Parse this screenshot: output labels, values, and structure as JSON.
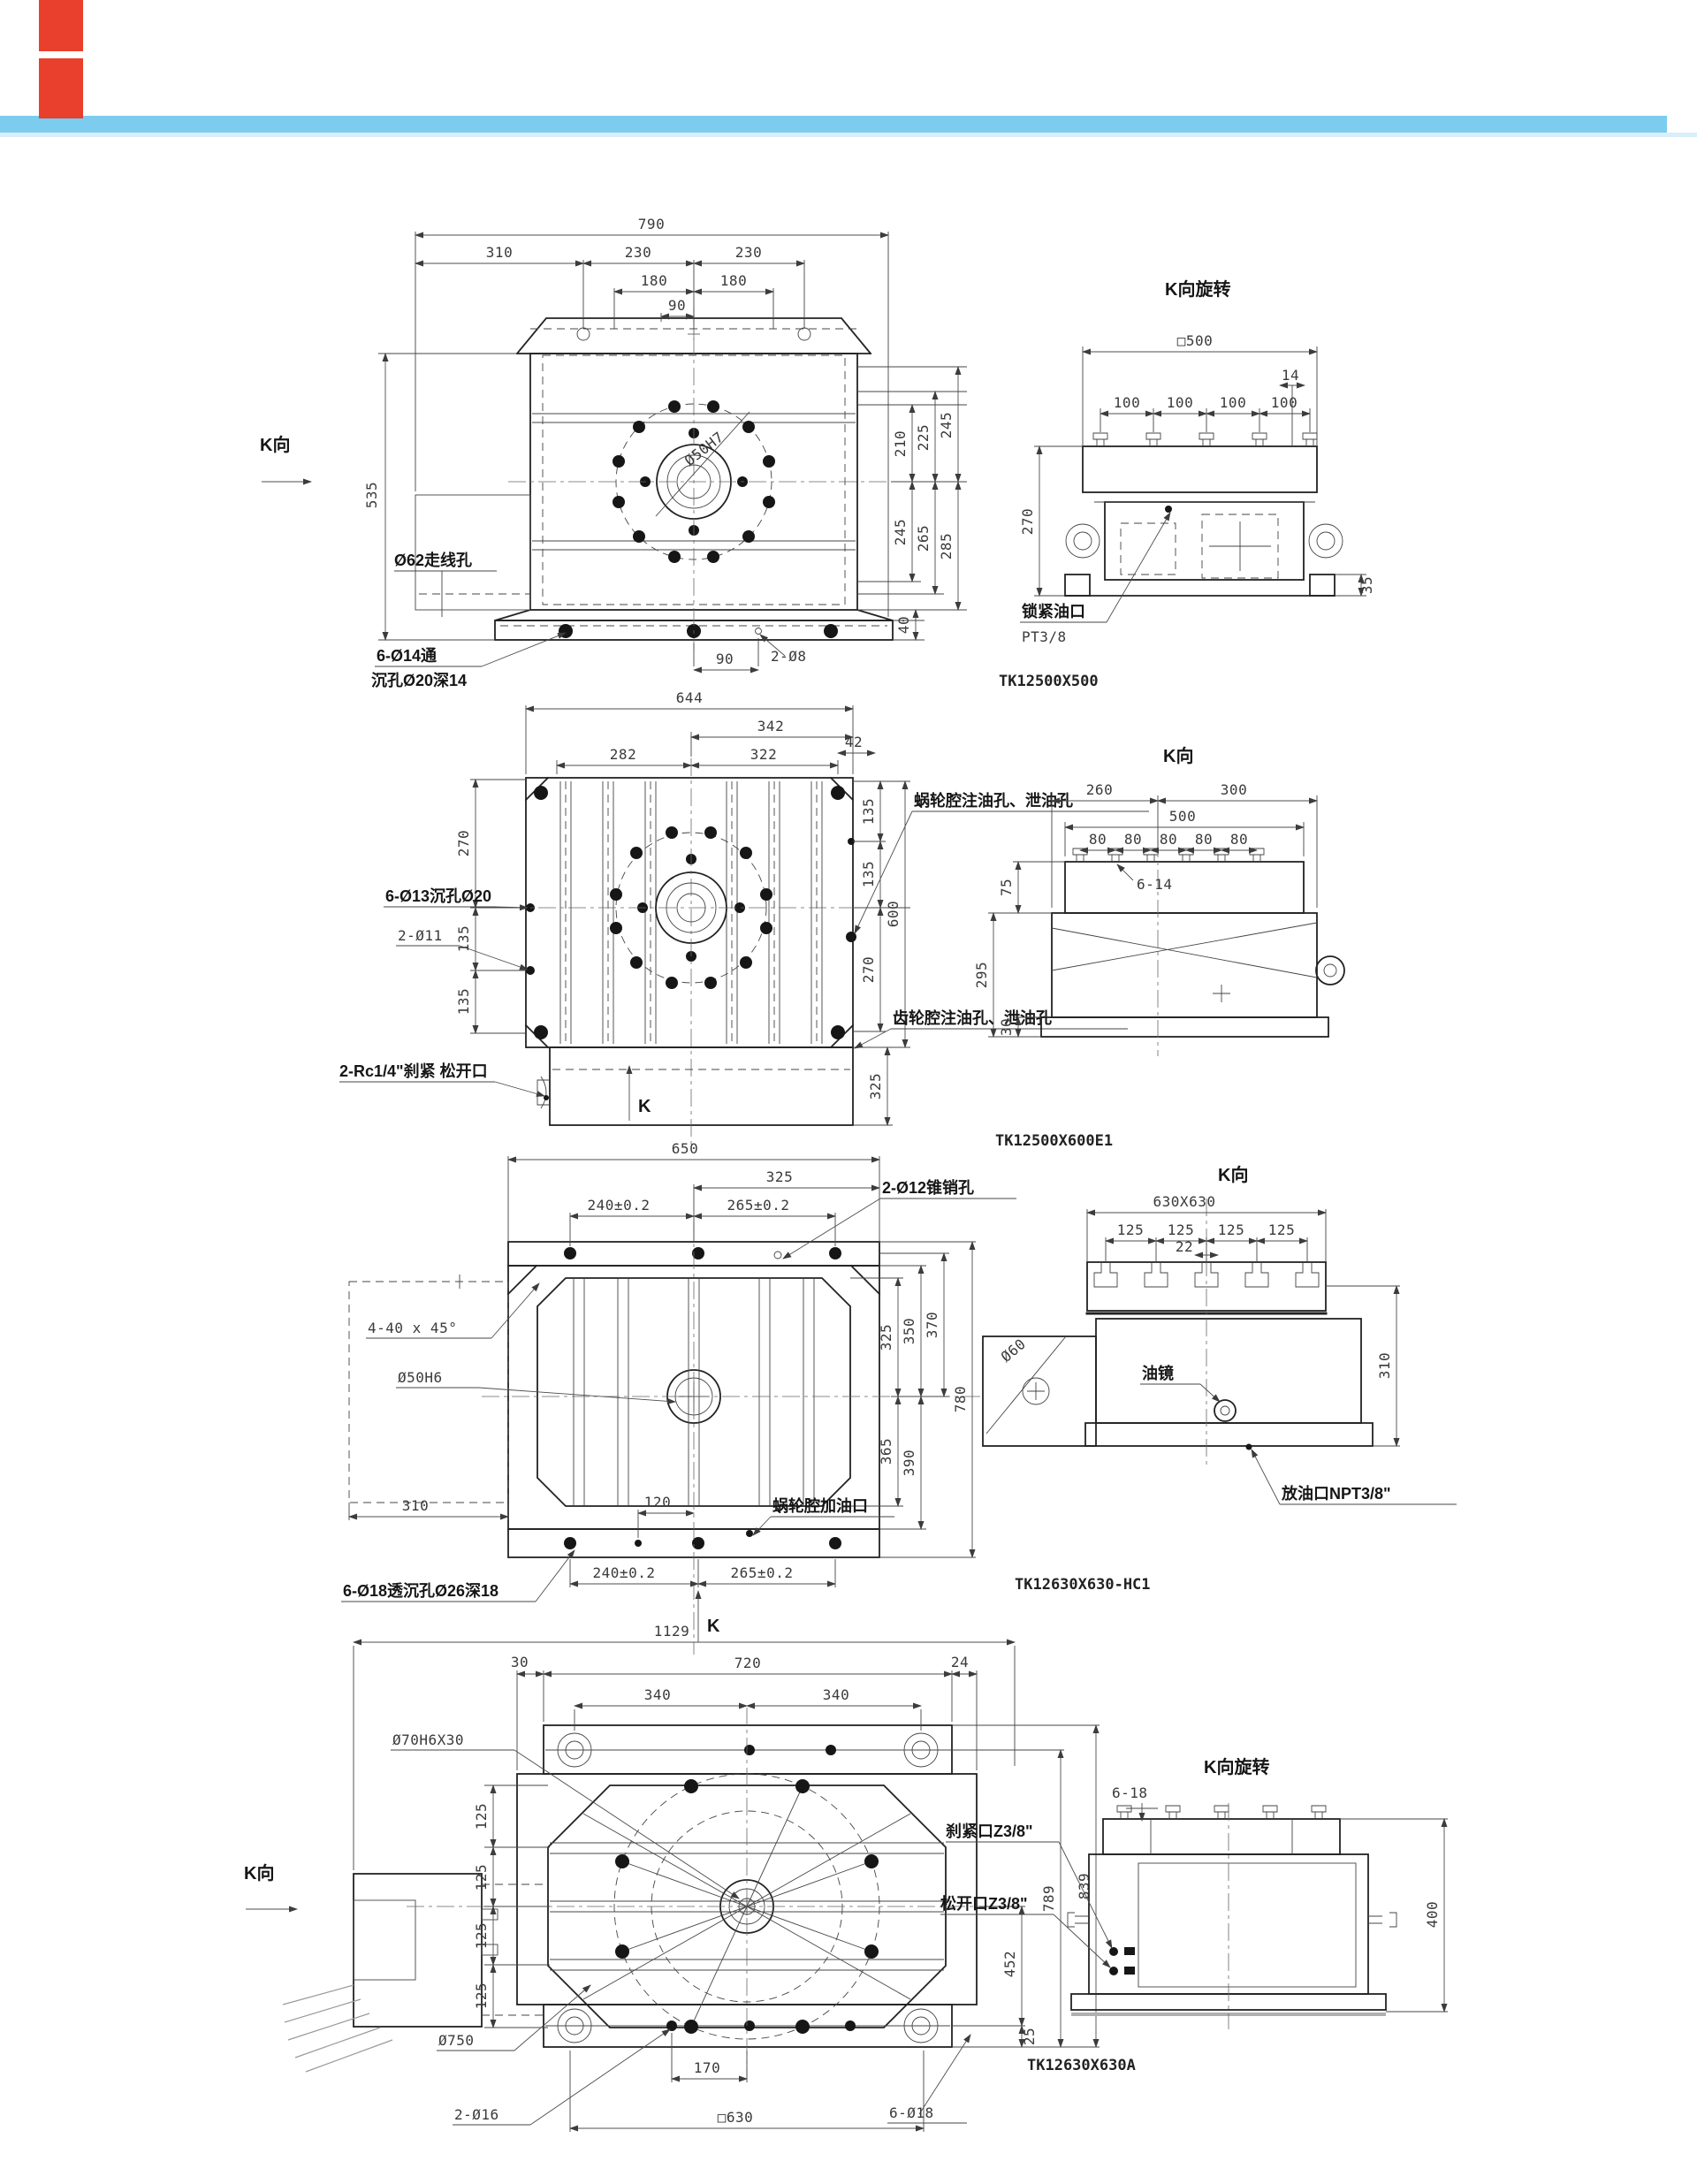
{
  "page": {
    "accent_band_color": "#7cccf0",
    "accent_band_light_color": "#d8eefa",
    "marker_color": "#e8402c"
  },
  "g1": {
    "model": "TK12500X500",
    "f": {
      "d790": "790",
      "d310": "310",
      "d230a": "230",
      "d230b": "230",
      "d180a": "180",
      "d180b": "180",
      "d90t": "90",
      "d535": "535",
      "d210": "210",
      "d225": "225",
      "d245a": "245",
      "d245b": "245",
      "d265": "265",
      "d285": "285",
      "d40": "40",
      "d90b": "90",
      "k": "K向",
      "wire": "Ø62走线孔",
      "cb1": "6-Ø14通",
      "cb2": "沉孔Ø20深14",
      "pin": "2-Ø8",
      "bore": "Ø50H7"
    },
    "s": {
      "title": "K向旋转",
      "d500": "□500",
      "d14": "14",
      "p1": "100",
      "p2": "100",
      "p3": "100",
      "p4": "100",
      "d270": "270",
      "d35": "35",
      "port1": "锁紧油口",
      "port2": "PT3/8"
    }
  },
  "g2": {
    "model": "TK12500X600E1",
    "f": {
      "d644": "644",
      "d342": "342",
      "d282": "282",
      "d322": "322",
      "d42": "42",
      "l270": "270",
      "l135a": "135",
      "l135b": "135",
      "r135a": "135",
      "r135b": "135",
      "r270": "270",
      "d600": "600",
      "d325": "325",
      "cb": "6-Ø13沉孔Ø20",
      "pin": "2-Ø11",
      "oil1": "蜗轮腔注油孔、泄油孔",
      "oil2": "齿轮腔注油孔、泄油孔",
      "brake": "2-Rc1/4\"刹紧 松开口",
      "k": "K"
    },
    "s": {
      "title": "K向",
      "d260": "260",
      "d300": "300",
      "d500": "500",
      "p1": "80",
      "p2": "80",
      "p3": "80",
      "p4": "80",
      "p5": "80",
      "slot": "6-14",
      "d75": "75",
      "d295": "295",
      "d30": "30"
    }
  },
  "g3": {
    "model": "TK12630X630-HC1",
    "f": {
      "d650": "650",
      "d325": "325",
      "d240t": "240±0.2",
      "d265t": "265±0.2",
      "r325": "325",
      "r350": "350",
      "r370": "370",
      "r365": "365",
      "r390": "390",
      "d780": "780",
      "d310": "310",
      "d120": "120",
      "d240b": "240±0.2",
      "d265b": "265±0.2",
      "pin": "2-Ø12锥销孔",
      "cham": "4-40 x 45°",
      "bore": "Ø50H6",
      "oil": "蜗轮腔加油口",
      "cb": "6-Ø18透沉孔Ø26深18",
      "k": "K"
    },
    "s": {
      "title": "K向",
      "dtop": "630X630",
      "p1": "125",
      "p2": "125",
      "p3": "125",
      "p4": "125",
      "d22": "22",
      "shaft": "Ø60",
      "d310": "310",
      "sight": "油镜",
      "drain": "放油口NPT3/8\""
    }
  },
  "g4": {
    "model": "TK12630X630A",
    "f": {
      "d1129": "1129",
      "d30": "30",
      "d720": "720",
      "d24": "24",
      "d340a": "340",
      "d340b": "340",
      "p1": "125",
      "p2": "125",
      "p3": "125",
      "p4": "125",
      "d789": "789",
      "d839": "839",
      "d452": "452",
      "d25": "25",
      "dia750": "Ø750",
      "pin": "2-Ø16",
      "d170": "170",
      "sq630": "□630",
      "holes": "6-Ø18",
      "bore": "Ø70H6X30",
      "k": "K向"
    },
    "s": {
      "title": "K向旋转",
      "slots": "6-18",
      "d400": "400",
      "brake": "刹紧口Z3/8\"",
      "release": "松开口Z3/8\""
    }
  }
}
